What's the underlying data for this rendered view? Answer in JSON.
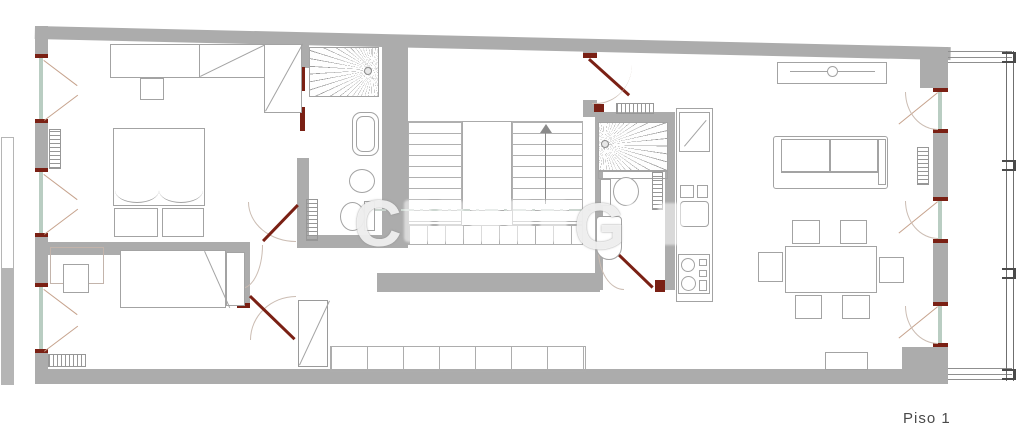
{
  "labels": {
    "floor": "Piso 1"
  },
  "watermark": {
    "letters": [
      "C",
      "G"
    ]
  },
  "colors": {
    "wall": "#acacac",
    "door": "#7a2014",
    "glass": "#b9cdc2",
    "case": "#c6a28c",
    "ln": "#a3a3a3",
    "label": "#4a4a4a",
    "arc": "#cbbcb2"
  },
  "plan": {
    "type": "floor-plan",
    "floor": "Piso 1",
    "rooms": [
      "bedroom-suite",
      "ensuite-bathroom",
      "bedroom-2",
      "hallway",
      "stair-hall",
      "bathroom-2",
      "kitchen",
      "living-dining-room",
      "balcony"
    ],
    "fixtures": [
      "wardrobe",
      "double-bed",
      "single-bed",
      "desk",
      "shower",
      "washbasin",
      "bidet",
      "toilet",
      "bathtub",
      "radiator",
      "staircase-up-arrow",
      "built-in-cabinets",
      "tv-sideboard",
      "sofa",
      "dining-table",
      "six-chairs",
      "kitchen-counter",
      "kitchen-sink",
      "stove",
      "french-windows",
      "casement-windows",
      "balcony-railing"
    ]
  }
}
